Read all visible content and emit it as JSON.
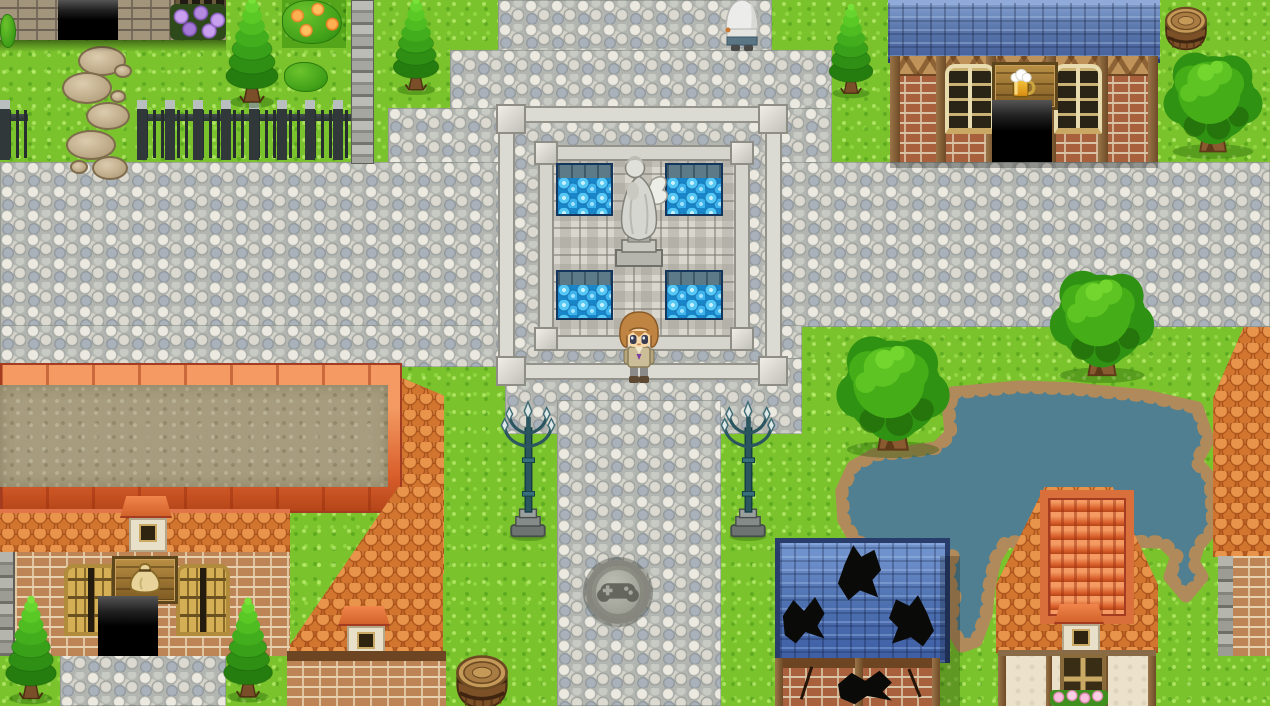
{
  "scene": {
    "label": "Top-down pixel RPG town plaza (RPG Maker style), daytime, no HUD text",
    "viewport": {
      "width": 1270,
      "height": 706
    }
  },
  "palette": {
    "grass": "#7ac32c",
    "grass_dark": "#55a51b",
    "cobblestone": "#c9cbc4",
    "stone_ledge": "#dcdbd3",
    "fountain_water": "#1886c8",
    "pond_water": "#4f7f90",
    "pond_rocks": "#b08a5a",
    "roof_blue_slate": "#5a77ab",
    "roof_orange_tile": "#c96b2b",
    "roof_flat_tan": "#a79d7e",
    "brick_red": "#a8613c",
    "brick_tan": "#bd8455",
    "timber": "#8a6b47",
    "plaster": "#ece2cc",
    "lamp_metal": "#2b565f",
    "fence_iron": "#30383a",
    "tree_green": "#2f9212",
    "barrel_wood": "#7d5128"
  },
  "entities": {
    "player": {
      "label": "player character, light-brown hair, tan outfit, facing south at fountain edge"
    },
    "npc": {
      "label": "white-hooded villager walking north at top of plaza"
    },
    "fountain": {
      "label": "square plaza fountain with four blue basins",
      "basins": 4
    },
    "statue": {
      "label": "stone angel statue on pedestal"
    },
    "tavern": {
      "label": "tavern: blue slate roof, brick and timber wall, beer-mug sign, open door",
      "sign_icon": "beer-mug"
    },
    "item_shop": {
      "label": "item shop: flat tan roof, orange tiled eaves, money-bag sign, open door",
      "sign_icon": "money-bag"
    },
    "north_house": {
      "label": "grey stone house at north edge with open door and barred window"
    },
    "damaged_house": {
      "label": "ruined house with holes in blue roof and cracked brick wall"
    },
    "cottage": {
      "label": "timber-framed cottage with dormer and pink window flower box"
    },
    "east_house": {
      "label": "orange-roofed house at east edge with brick wall"
    },
    "pond": {
      "label": "rock-edged teal pond with two outflow creeks"
    },
    "manhole": {
      "label": "round pavement emblem engraved with a gamepad",
      "icon": "gamepad"
    },
    "lamp_left": {
      "label": "ornate teal street lamp on stone base"
    },
    "lamp_right": {
      "label": "ornate teal street lamp on stone base"
    },
    "barrel_north": {
      "label": "wooden barrel beside tavern"
    },
    "barrel_south": {
      "label": "wooden barrel beside south road"
    },
    "fence": {
      "label": "dark iron picket fence with stone caps"
    },
    "stepping_stones": {
      "label": "stepping-stone path through yard"
    },
    "stone_pillar": {
      "label": "stacked stone pillar wall"
    },
    "trees": {
      "conifers": 5,
      "round_trees": 3
    },
    "bushes": {
      "orange_flower_bush": 1,
      "purple_flower_box": 1,
      "green_bush": 1
    }
  }
}
